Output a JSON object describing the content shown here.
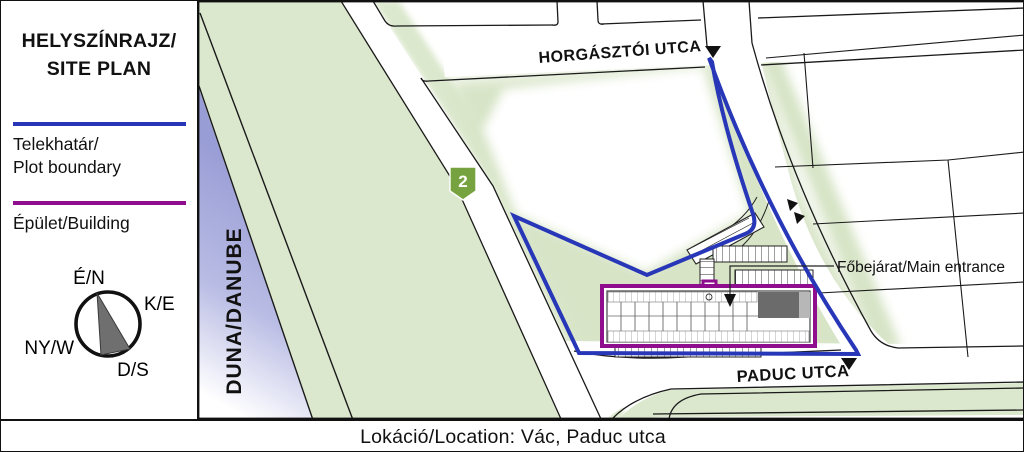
{
  "legend": {
    "title": {
      "line1": "HELYSZÍNRAJZ/",
      "line2": "SITE PLAN"
    },
    "items": [
      {
        "label_line1": "Telekhatár/",
        "label_line2": "Plot boundary",
        "color": "#2737b8"
      },
      {
        "label_line1": "Épület/Building",
        "color": "#8e0e8e"
      }
    ]
  },
  "compass": {
    "north": "É/N",
    "east": "K/E",
    "south": "D/S",
    "west": "NY/W"
  },
  "map": {
    "river_label": "DUNA/DANUBE",
    "streets": [
      {
        "name": "HORGÁSZTÓI UTCA"
      },
      {
        "name": "PADUC UTCA"
      }
    ],
    "road_badge": "2",
    "entrance_label": "Főbejárat/Main entrance",
    "colors": {
      "green_area": "#dce8cd",
      "river": "#9b9ed6",
      "plot_boundary": "#2737b8",
      "building": "#8e0e8e",
      "road_badge_green": "#76a33f"
    }
  },
  "footer": {
    "location": "Lokáció/Location: Vác, Paduc utca"
  }
}
